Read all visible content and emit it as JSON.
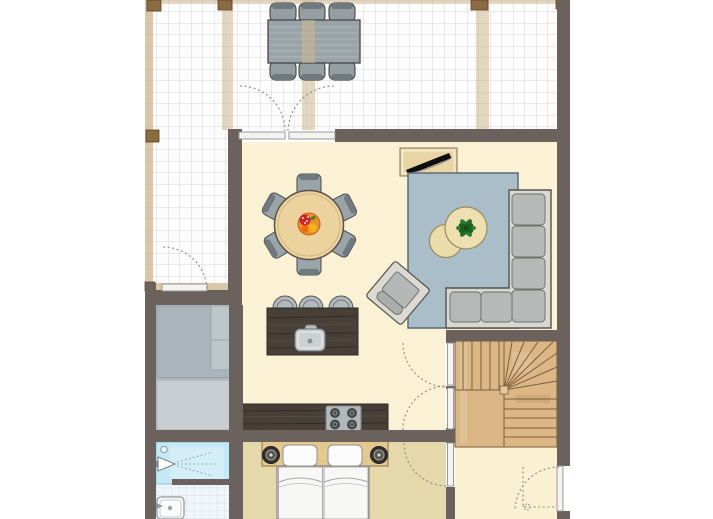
{
  "colors": {
    "wall": "#6b625e",
    "floor_living": "#fbf1d5",
    "floor_bedroom": "#e5d8ab",
    "floor_hall": "#faf0d2",
    "floor_utility": "#c4cbce",
    "tile_bg": "#fcfcfc",
    "tile_line": "#d7d7d7",
    "bath_tile_bg": "#f0f6f9",
    "bath_tile_line": "#d3e1eb",
    "shower": "#c4e8f6",
    "rug": "#a9bec9",
    "sofa_frame": "#d8d8d2",
    "sofa_cushion": "#b5b9b7",
    "wood_dark": "#483f37",
    "wood_table": "#ecd39e",
    "wood_stairs": "#dab785",
    "wood_headboard": "#e3c88f",
    "cabinet": "#e9d5a3",
    "stool": "#b2b9bc",
    "stove": "#b2b8ba",
    "plant": "#2e7d32",
    "fruit_orange": "#e8912a",
    "door_leaf": "#f4f3ef",
    "post": "#8a6b42",
    "chair_gray": "#9ba4a8"
  },
  "elements": {
    "terrace": {
      "outdoor_dining_seats": 6,
      "pergola_beams": 3,
      "corner_posts": 4,
      "floor": "white tile grid"
    },
    "living_dining": {
      "dining_seats": 6,
      "table_shape": "round",
      "centerpiece": "fruit-bowl",
      "sofa": "L-shaped corner sofa",
      "coffee_tables": 2,
      "armchair": 1,
      "rug": 1,
      "tv_sideboard": 1,
      "plant": 1
    },
    "kitchen": {
      "bar_stools": 3,
      "island_sink": 1,
      "stove_burners": 4
    },
    "bedroom": {
      "bed": "double",
      "pillows": 2,
      "reading_lamps": 2
    },
    "bathroom": {
      "shower": 1,
      "washbasin": 1
    },
    "stairs": {
      "type": "L-shaped winder staircase"
    },
    "doors": {
      "double_door_sets": 2,
      "single_doors": 4,
      "swing_arcs": "dotted"
    }
  }
}
